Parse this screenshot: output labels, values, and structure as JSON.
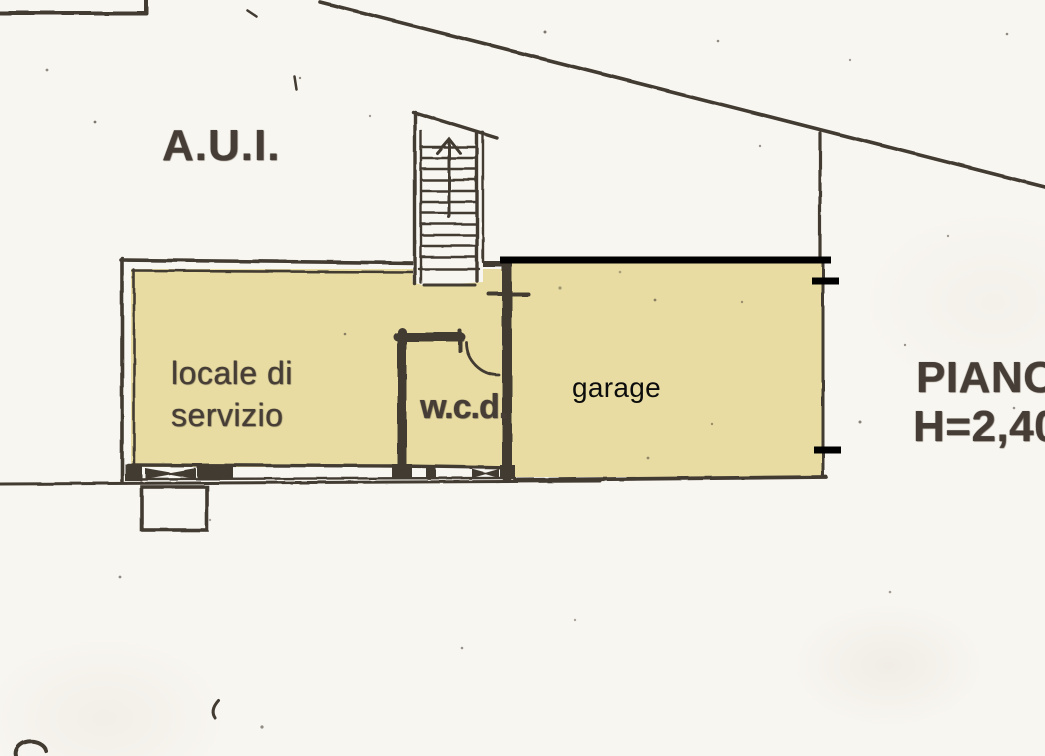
{
  "document": {
    "kind": "scanned floor plan (planimetria catastale)",
    "colors": {
      "paper": "#f8f6f1",
      "room_fill": "#e8dca3",
      "scan_line": "#423a32",
      "digital_annotation": "#000000"
    }
  },
  "labels": {
    "zone": "A.U.I.",
    "service_room_line1": "locale di",
    "service_room_line2": "servizio",
    "wc": "w.c.d.",
    "garage": "garage",
    "floor_line1": "PIANO",
    "floor_line2": "H=2,40"
  },
  "annotations": {
    "garage_top_highlight": "thick black line over garage north wall",
    "tick_marks": [
      "right wall upper tick",
      "right wall lower tick",
      "cross mark on internal wall"
    ],
    "stair_direction": "up-arrow"
  }
}
